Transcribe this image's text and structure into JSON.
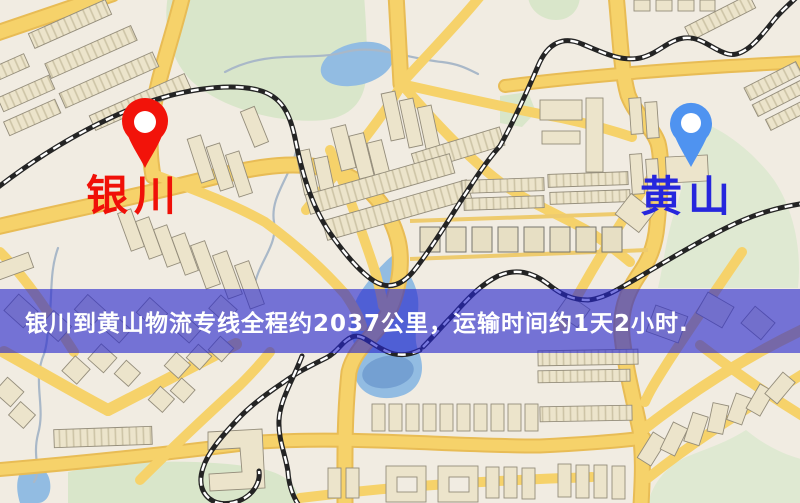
{
  "map": {
    "markers": [
      {
        "name": "origin",
        "label": "银川",
        "label_color": "#f01008",
        "pin_color": "#f2130a",
        "icon": "map-pin-icon"
      },
      {
        "name": "destination",
        "label": "黄山",
        "label_color": "#2626dd",
        "pin_color": "#4f93f0",
        "icon": "map-pin-icon"
      }
    ]
  },
  "banner": {
    "text": "银川到黄山物流专线全程约2037公里，运输时间约1天2小时.",
    "text_color": "#ffffff",
    "bg_color": "#2626cd",
    "bg_opacity": "0.62"
  },
  "palette": {
    "map_background": "#f1ece2",
    "road_fill": "#f6d26a",
    "road_casing": "#e8bc55",
    "park_green": "#d9e6ca",
    "water_blue": "#92bce2",
    "railway_black": "#242424",
    "building_beige": "#ece4cb"
  }
}
